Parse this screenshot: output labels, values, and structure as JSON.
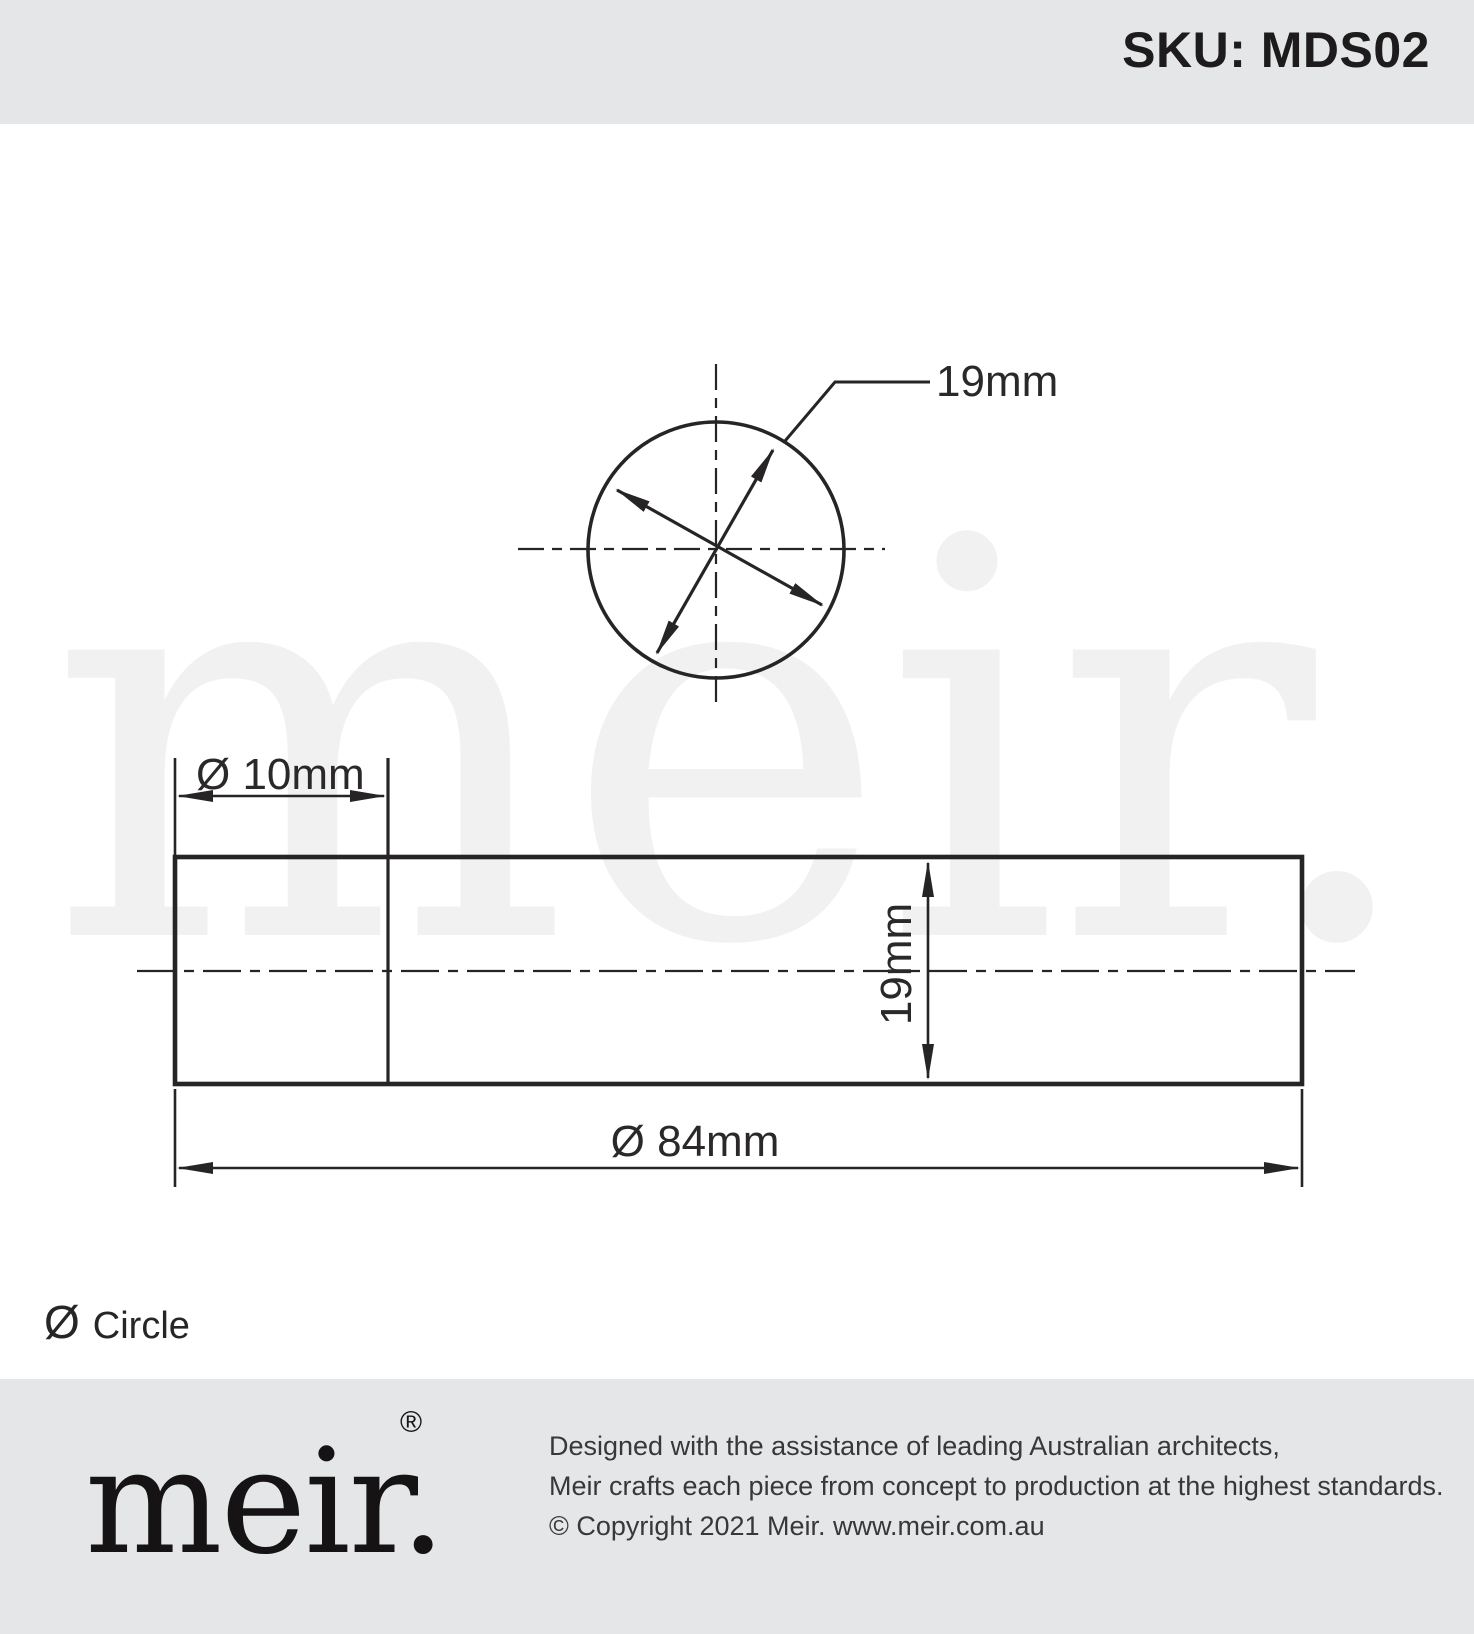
{
  "header": {
    "sku": "SKU: MDS02"
  },
  "watermark": {
    "text": "meir."
  },
  "drawing": {
    "top_view": {
      "diameter_label": "19mm"
    },
    "side_view": {
      "step_diameter_label": "Ø 10mm",
      "body_diameter_label": "19mm",
      "length_label": "Ø 84mm"
    }
  },
  "legend": {
    "symbol": "Ø",
    "label": "Circle"
  },
  "footer": {
    "logo_text": "meir.",
    "registered_mark": "®",
    "lines": [
      "Designed with the assistance of leading Australian architects,",
      "Meir crafts each piece from concept to production at the highest standards.",
      "© Copyright 2021 Meir. www.meir.com.au"
    ]
  },
  "colors": {
    "band_gray": "#e5e6e7",
    "line_black": "#272425",
    "watermark_gray": "#f1f1f2"
  }
}
